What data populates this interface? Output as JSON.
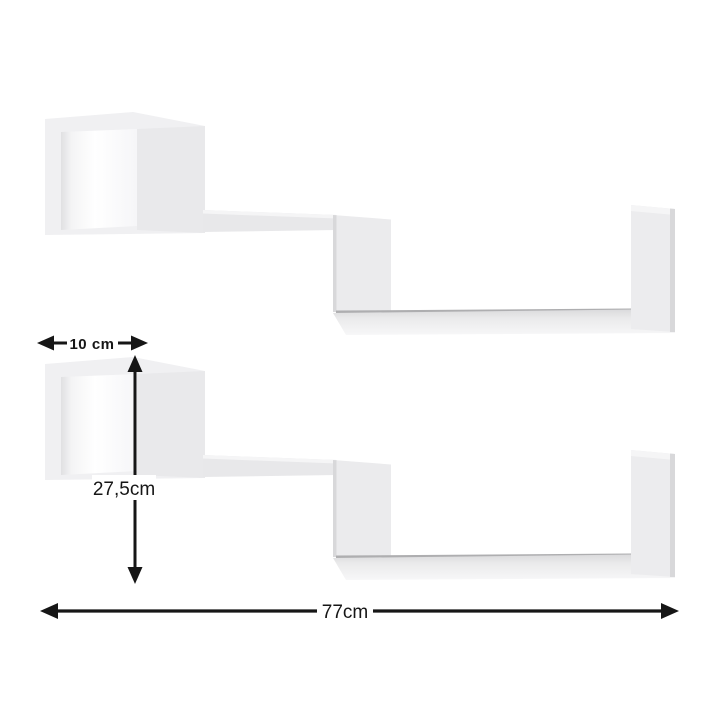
{
  "image": {
    "type": "product-dimension-diagram",
    "background_color": "#ffffff",
    "shelf_count": 2
  },
  "dimensions": {
    "depth_label": "10 cm",
    "height_label": "27,5cm",
    "width_label": "77cm"
  },
  "colors": {
    "annotation": "#161616",
    "shelf_main": "#f0f0f2",
    "shelf_panel": "#e9e9eb",
    "shelf_mid": "#e8e8ea",
    "shelf_step": "#ebebed",
    "shelf_leg": "#ececee",
    "shelf_edge_dark": "#aeaeb0",
    "shelf_edge_soft": "#d8d8da",
    "shelf_highlight": "#f5f5f6"
  }
}
